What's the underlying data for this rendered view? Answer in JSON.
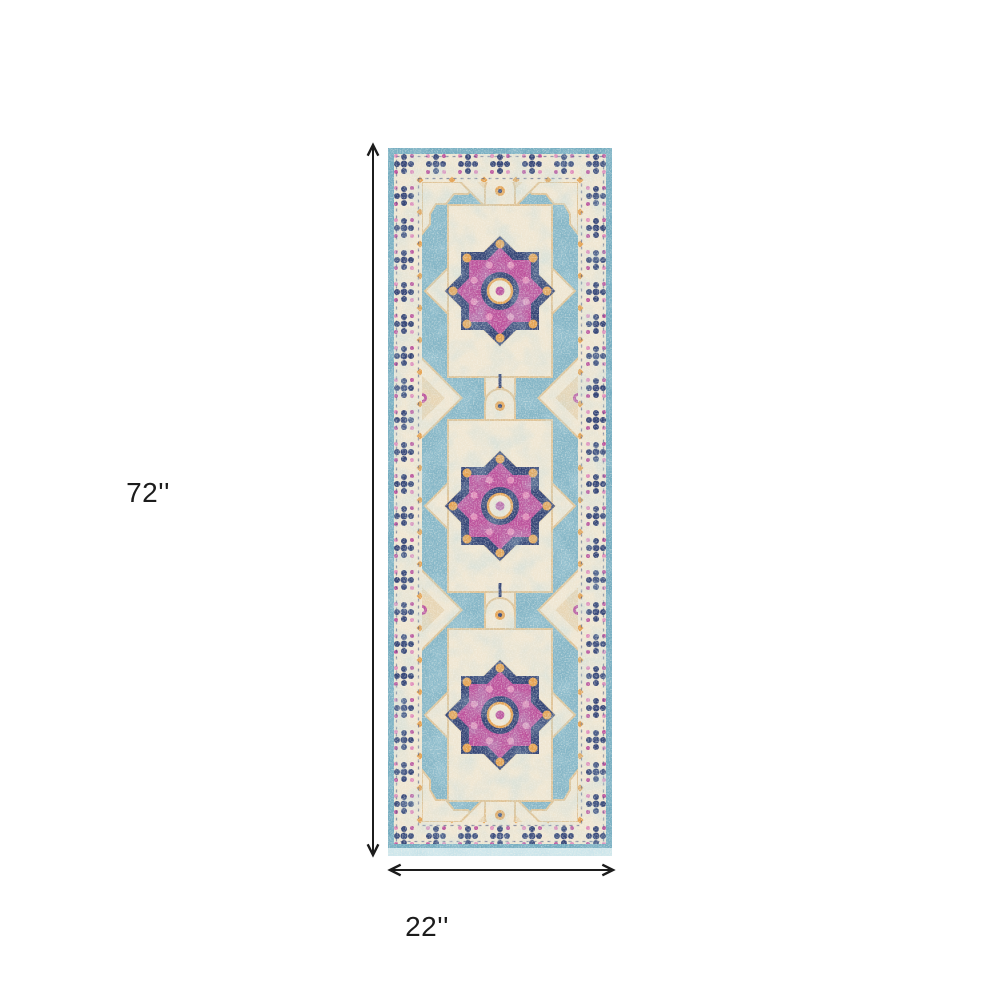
{
  "page": {
    "background_color": "#ffffff",
    "content_type": "product dimension diagram"
  },
  "rug": {
    "style": "distressed Persian medallion runner rug",
    "medallion_count": 3,
    "palette": {
      "field_blue": "#84b5c6",
      "edge_teal": "#72abbf",
      "fringe_light": "#cfe7ec",
      "border_cream": "#efe6d2",
      "accent_tan": "#dfc396",
      "accent_navy": "#344475",
      "accent_magenta": "#bc529c",
      "accent_pink": "#e08cba",
      "accent_orange": "#e5a251"
    }
  },
  "dimensions": {
    "height_label": "72''",
    "width_label": "22''",
    "line_color": "#1c1c1c"
  }
}
